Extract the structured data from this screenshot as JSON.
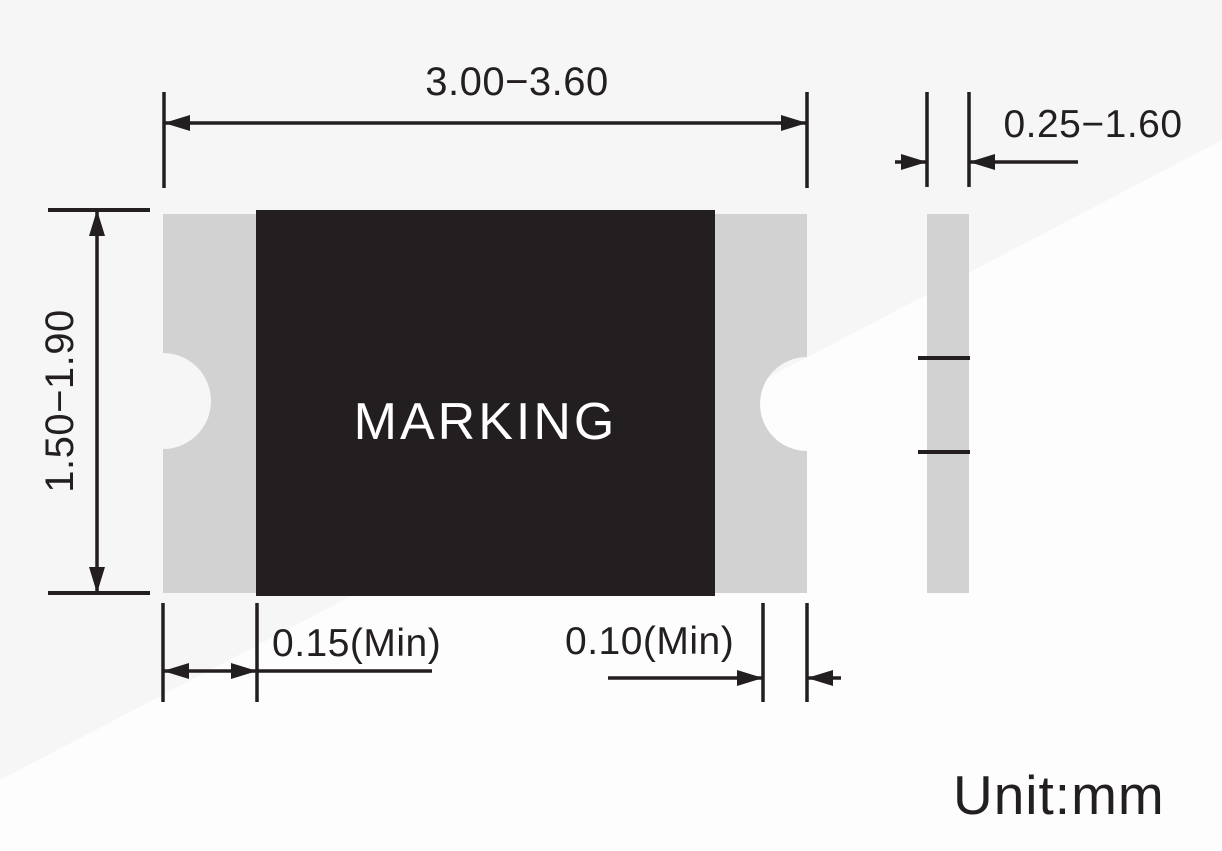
{
  "drawing": {
    "top_view": {
      "marking_label": "MARKING"
    },
    "dimensions": {
      "body_width": "3.00−3.60",
      "body_height": "1.50−1.90",
      "left_pad_min": "0.15(Min)",
      "right_pad_min": "0.10(Min)",
      "thickness": "0.25−1.60"
    },
    "unit_note": "Unit:mm",
    "colors": {
      "body": "#231f20",
      "pad": "#d2d2d3",
      "line": "#231f20",
      "background": "#f6f6f7",
      "highlight": "#fdfdfe"
    }
  }
}
